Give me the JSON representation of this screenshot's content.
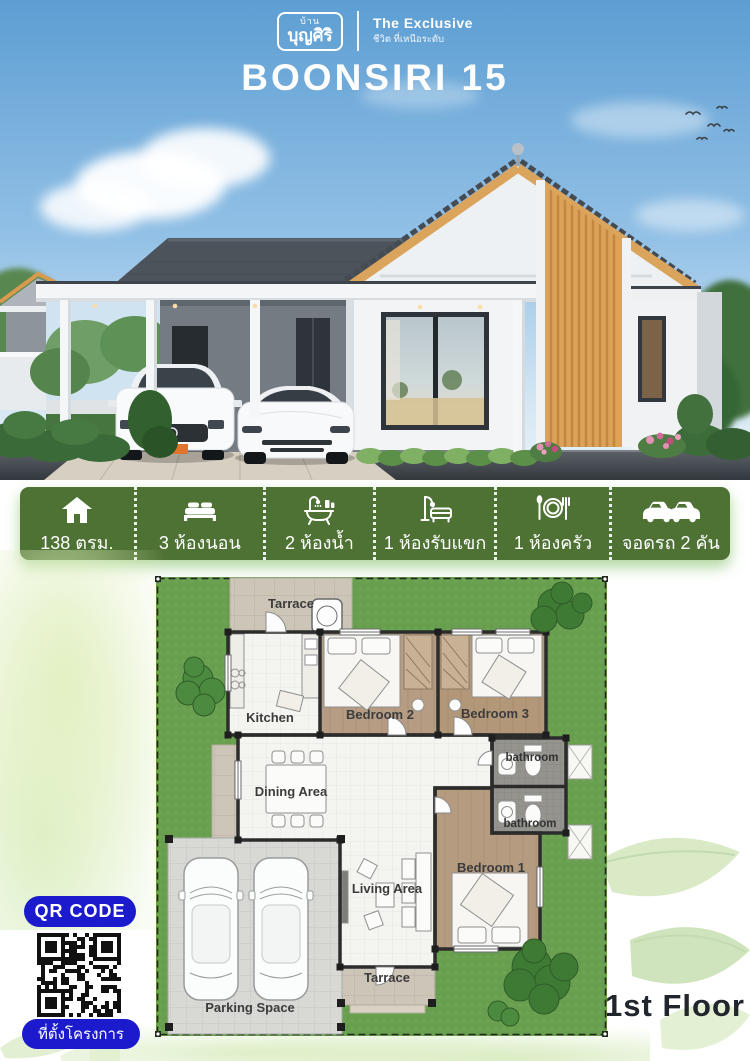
{
  "header": {
    "logo": {
      "brand_top": "บ้าน",
      "brand_name": "บุญศิริ",
      "tagline_title": "The Exclusive",
      "tagline_sub": "ชีวิต ที่เหนือระดับ"
    },
    "title": "BOONSIRI 15"
  },
  "banner": {
    "items": [
      {
        "icon": "house-icon",
        "label": "138 ตรม."
      },
      {
        "icon": "bed-icon",
        "label": "3 ห้องนอน"
      },
      {
        "icon": "bath-icon",
        "label": "2 ห้องน้ำ"
      },
      {
        "icon": "sofa-icon",
        "label": "1 ห้องรับแขก"
      },
      {
        "icon": "dining-icon",
        "label": "1 ห้องครัว"
      },
      {
        "icon": "cars-icon",
        "label": "จอดรถ 2 คัน"
      }
    ]
  },
  "floor_plan": {
    "floor_label": "1st Floor",
    "room_labels": {
      "terrace_top": "Tarrace",
      "kitchen": "Kitchen",
      "bedroom2": "Bedroom 2",
      "bedroom3": "Bedroom 3",
      "bathroom_top": "bathroom",
      "bathroom_bottom": "bathroom",
      "dining": "Dining Area",
      "living": "Living Area",
      "bedroom1": "Bedroom 1",
      "terrace_bottom": "Tarrace",
      "parking": "Parking Space"
    }
  },
  "qr": {
    "button_label": "QR CODE",
    "caption_label": "ที่ตั้งโครงการ"
  },
  "colors": {
    "banner_green": "#4e7234",
    "qr_blue": "#1b1bcd",
    "lawn_green": "#6aa150",
    "wood_accent": "#dca25a"
  }
}
